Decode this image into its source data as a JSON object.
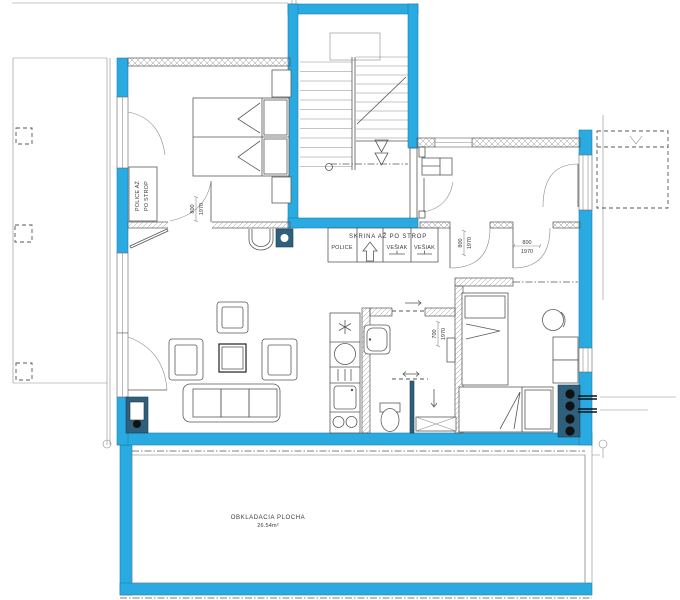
{
  "colors": {
    "wall_fill": "#29ABE2",
    "fixture_dark": "#2E5F7D",
    "line": "#555555"
  },
  "labels": {
    "shelf_unit": {
      "line1": "POLICE AŽ",
      "line2": "PO STROP"
    },
    "wardrobe": {
      "title": "SKRINA AŽ PO STROP",
      "shelves": "POLICE",
      "hanger1": "VEŠIAK",
      "hanger2": "VEŠIAK"
    },
    "terrace": {
      "line1": "OBKLADACIA PLOCHA",
      "line2": "26.54m²"
    }
  },
  "dims": {
    "bedroom_door": {
      "w": "800",
      "h": "1970"
    },
    "hall_door_a": {
      "w": "800",
      "h": "1970"
    },
    "hall_door_b": {
      "w": "800",
      "h": "1970"
    },
    "bathroom_door": {
      "w": "700",
      "h": "1970"
    }
  },
  "icons": {
    "wardrobe_direction": "up-arrow",
    "bathroom_slide": "left-right-arrow",
    "bathroom_entry": "right-arrow",
    "shower_flow": "down-arrow",
    "stairs_down": "double-triangle-down"
  }
}
